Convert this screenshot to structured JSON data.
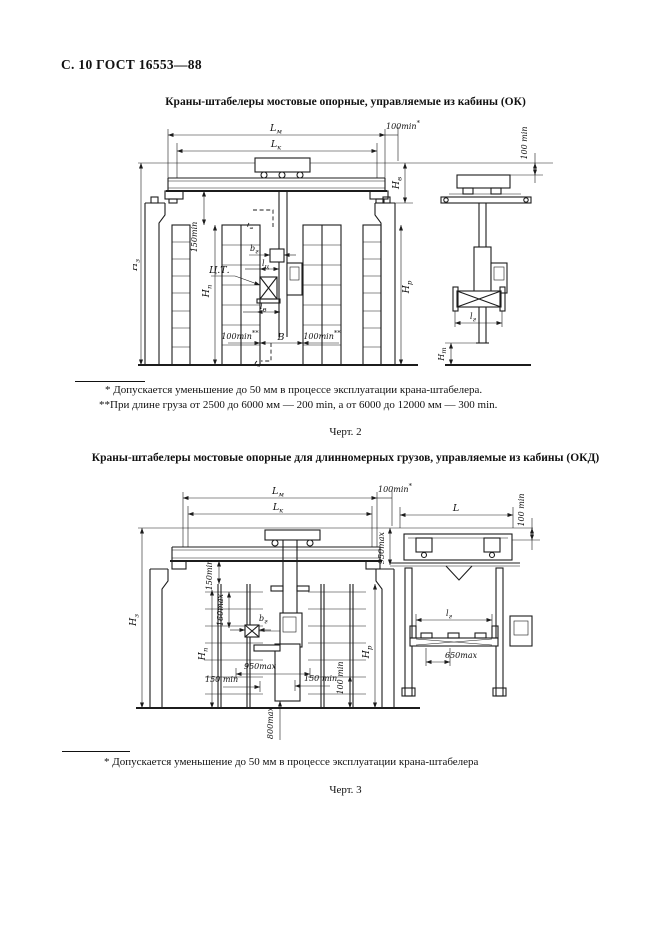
{
  "page": {
    "header": "С. 10 ГОСТ 16553—88"
  },
  "fig2_block": {
    "title": "Краны-штабелеры мостовые опорные, управляемые из кабины (ОК)",
    "footnote1": "* Допускается уменьшение до 50 мм в процессе эксплуатации крана-штабелера.",
    "footnote2": "**При длине груза от 2500 до 6000 мм — 200 min, а от 6000 до 12000 мм — 300 min.",
    "caption": "Черт. 2"
  },
  "fig3_block": {
    "title": "Краны-штабелеры мостовые опорные для длинномерных грузов, управляемые из кабины (ОКД)",
    "footnote1": "* Допускается уменьшение до 50 мм в процессе эксплуатации крана-штабелера",
    "caption": "Черт. 3"
  },
  "f1": {
    "Lm_b": "L",
    "Lm_s": "м",
    "Lk_b": "L",
    "Lk_s": "к",
    "min100": "100min",
    "star": "*",
    "dstar": "**",
    "Hv_b": "Н",
    "Hv_s": "в",
    "Hz_b": "Н",
    "Hz_s": "з",
    "min150": "150min",
    "Hn_b": "Н",
    "Hn_s": "п",
    "ct": "Ц.Т.",
    "bg_b": "b",
    "bg_s": "г",
    "lc_b": "l",
    "lc_s": "ц",
    "lv_b": "l",
    "lv_s": "в",
    "B": "В",
    "Hr_b": "Н",
    "Hr_s": "р",
    "min100_side": "100 min",
    "lg_b": "l",
    "lg_s": "г",
    "Ht_b": "Н",
    "Ht_s": "т"
  },
  "f2": {
    "Lm_b": "L",
    "Lm_s": "м",
    "Lk_b": "L",
    "Lk_s": "к",
    "min100": "100min",
    "star": "*",
    "max950": "950max",
    "Hz_b": "Н",
    "Hz_s": "з",
    "min150rot": "150min",
    "max160": "160max",
    "bg_b": "b",
    "bg_s": "г",
    "Hn_b": "Н",
    "Hn_s": "п",
    "min150_l": "150 min",
    "min150_r": "150 min",
    "min100rot": "100 min",
    "Hr_b": "Н",
    "Hr_s": "р",
    "max800": "800max",
    "L": "L",
    "min100_side": "100 min",
    "lg_b": "l",
    "lg_s": "г",
    "max650": "650max"
  }
}
